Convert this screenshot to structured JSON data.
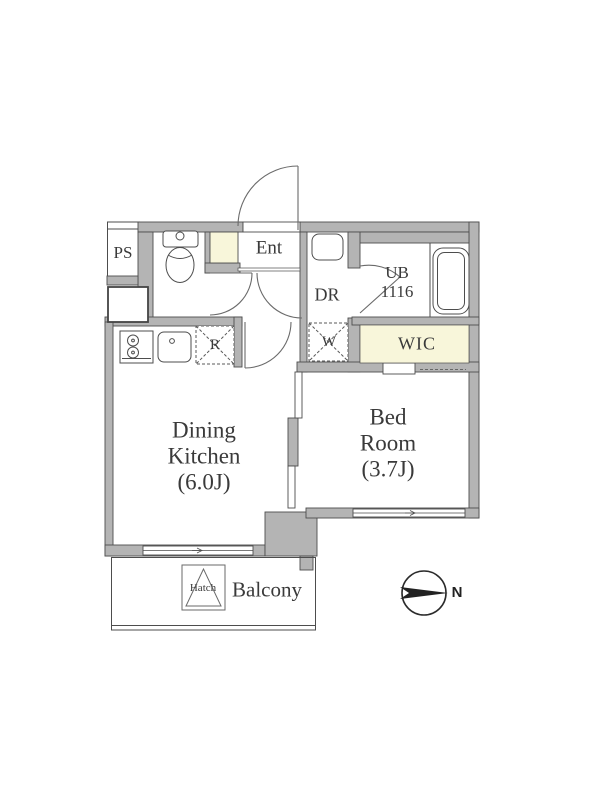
{
  "plan": {
    "title": "apartment-floor-plan",
    "labels": {
      "ps": "PS",
      "ent": "Ent",
      "dr": "DR",
      "ub_line1": "UB",
      "ub_line2": "1116",
      "wic": "WIC",
      "washer_space": "W",
      "fridge_space": "R",
      "dk_line1": "Dining",
      "dk_line2": "Kitchen",
      "dk_line3": "(6.0J)",
      "bed_line1": "Bed",
      "bed_line2": "Room",
      "bed_line3": "(3.7J)",
      "balcony": "Balcony",
      "hatch": "Hatch",
      "north": "N"
    },
    "colors": {
      "wall_fill": "#b4b4b4",
      "wall_line": "#4d4d4d",
      "floor_accent": "#f8f6da",
      "text": "#3a3a3a"
    }
  }
}
